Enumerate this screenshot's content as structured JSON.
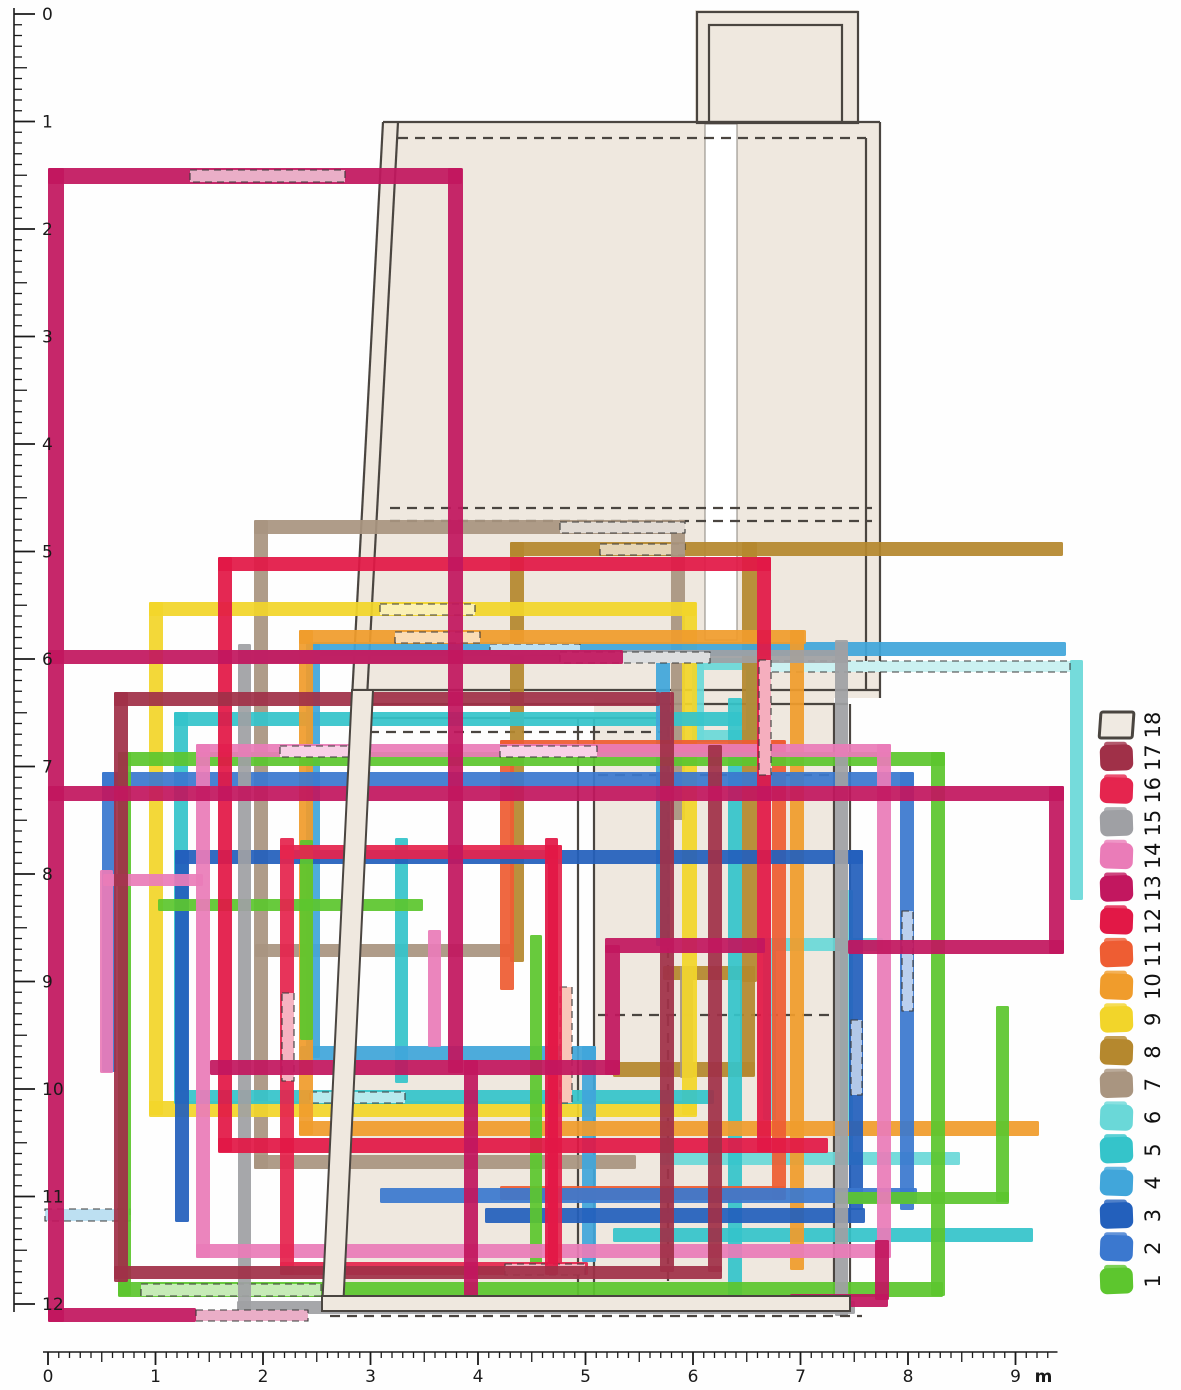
{
  "figure": {
    "kind": "archaeological-phase-plan",
    "width": 1181,
    "height": 1390,
    "paper_color": "#fefefe",
    "plan_fill": "#efe8df",
    "plan_stroke": "#4a4540"
  },
  "legend": {
    "swatch_x": 1100,
    "swatch_w": 33,
    "swatch_h": 26,
    "center_y_top": 725,
    "pitch": 32.7,
    "number_x": 1152,
    "number_font": 21,
    "items": [
      {
        "n": "18",
        "color": "#f0eae2",
        "outlined": true
      },
      {
        "n": "17",
        "color": "#a03048"
      },
      {
        "n": "16",
        "color": "#e5254e"
      },
      {
        "n": "15",
        "color": "#9fa0a4"
      },
      {
        "n": "14",
        "color": "#ea7cb8"
      },
      {
        "n": "13",
        "color": "#c2175f"
      },
      {
        "n": "12",
        "color": "#e21846"
      },
      {
        "n": "11",
        "color": "#ee5d33"
      },
      {
        "n": "10",
        "color": "#f09c2c"
      },
      {
        "n": "9",
        "color": "#f2d52a"
      },
      {
        "n": "8",
        "color": "#b5882e"
      },
      {
        "n": "7",
        "color": "#a99580"
      },
      {
        "n": "6",
        "color": "#6ad8d8"
      },
      {
        "n": "5",
        "color": "#35c4ca"
      },
      {
        "n": "4",
        "color": "#41a6da"
      },
      {
        "n": "3",
        "color": "#2360bc"
      },
      {
        "n": "2",
        "color": "#3b78cf"
      },
      {
        "n": "1",
        "color": "#5dc62e"
      }
    ]
  },
  "rulers": {
    "left": {
      "line_x": 14,
      "y0": 14,
      "unit": 107.5,
      "n_units": 12,
      "minor_per_unit": 10,
      "tick_major": 21,
      "tick_half": 13,
      "tick_minor": 8,
      "label_x": 30,
      "font": 17,
      "labels": [
        "0",
        "1",
        "2",
        "3",
        "4",
        "5",
        "6",
        "7",
        "8",
        "9",
        "10",
        "11",
        "12"
      ]
    },
    "bottom": {
      "line_y": 1352,
      "x0": 48,
      "unit": 107.5,
      "n_units": 9,
      "minor_per_unit": 10,
      "tick_major": 13,
      "tick_half": 10,
      "tick_minor": 6,
      "label_dy": 30,
      "font": 17,
      "labels": [
        "0",
        "1",
        "2",
        "3",
        "4",
        "5",
        "6",
        "7",
        "8",
        "9"
      ],
      "unit_label": "m"
    }
  },
  "plan": {
    "fills": [
      {
        "type": "rect",
        "x": 695,
        "y": 10,
        "w": 163,
        "h": 115
      },
      {
        "type": "poly",
        "points": "383,122 880,122 880,698 352,698"
      },
      {
        "type": "rect",
        "x": 705,
        "y": 124,
        "w": 32,
        "h": 516,
        "white": true
      },
      {
        "type": "rect",
        "x": 594,
        "y": 698,
        "w": 240,
        "h": 612
      },
      {
        "type": "rect",
        "x": 335,
        "y": 1050,
        "w": 259,
        "h": 258
      }
    ],
    "outline_rects": [
      {
        "x": 697,
        "y": 12,
        "w": 161,
        "h": 111
      },
      {
        "x": 709,
        "y": 25,
        "w": 133,
        "h": 97
      }
    ],
    "lines": [
      {
        "x1": 383,
        "y1": 122,
        "x2": 352,
        "y2": 698
      },
      {
        "x1": 398,
        "y1": 122,
        "x2": 367,
        "y2": 698
      },
      {
        "x1": 383,
        "y1": 122,
        "x2": 880,
        "y2": 122
      },
      {
        "x1": 398,
        "y1": 138,
        "x2": 866,
        "y2": 138,
        "dash": true
      },
      {
        "x1": 880,
        "y1": 122,
        "x2": 880,
        "y2": 698
      },
      {
        "x1": 866,
        "y1": 138,
        "x2": 866,
        "y2": 690
      },
      {
        "x1": 390,
        "y1": 508,
        "x2": 872,
        "y2": 508,
        "dash": true
      },
      {
        "x1": 390,
        "y1": 521,
        "x2": 872,
        "y2": 521,
        "dash": true
      },
      {
        "x1": 352,
        "y1": 690,
        "x2": 880,
        "y2": 690
      },
      {
        "x1": 352,
        "y1": 704,
        "x2": 848,
        "y2": 704
      },
      {
        "x1": 352,
        "y1": 718,
        "x2": 662,
        "y2": 718
      },
      {
        "x1": 352,
        "y1": 732,
        "x2": 662,
        "y2": 732,
        "dash": true
      },
      {
        "x1": 578,
        "y1": 718,
        "x2": 578,
        "y2": 1296
      },
      {
        "x1": 594,
        "y1": 718,
        "x2": 594,
        "y2": 1296
      },
      {
        "x1": 834,
        "y1": 704,
        "x2": 834,
        "y2": 1296
      },
      {
        "x1": 850,
        "y1": 704,
        "x2": 850,
        "y2": 1296
      },
      {
        "x1": 598,
        "y1": 775,
        "x2": 832,
        "y2": 775,
        "dash": true
      },
      {
        "x1": 598,
        "y1": 1015,
        "x2": 832,
        "y2": 1015,
        "dash": true
      },
      {
        "x1": 668,
        "y1": 710,
        "x2": 668,
        "y2": 1285,
        "dash": true
      }
    ],
    "bands_over": [
      {
        "type": "poly",
        "points": "352,690 373,690 343,1310 322,1310"
      },
      {
        "type": "rect",
        "x": 322,
        "y": 1296,
        "w": 528,
        "h": 15
      }
    ],
    "bands_over_dash": [
      {
        "x1": 330,
        "y1": 1316,
        "x2": 862,
        "y2": 1316
      }
    ]
  },
  "phases": {
    "draw_order": [
      "6",
      "8",
      "7",
      "9",
      "5",
      "4",
      "10",
      "11",
      "3",
      "2",
      "1",
      "15",
      "14",
      "16",
      "12",
      "17",
      "13"
    ],
    "byId": {
      "6": {
        "color": "#6ad8d8",
        "bars": [
          [
            692,
            658,
            66,
            12
          ],
          [
            692,
            658,
            12,
            84
          ],
          [
            746,
            658,
            12,
            84
          ],
          [
            692,
            730,
            66,
            12
          ],
          [
            1070,
            660,
            13,
            240
          ],
          [
            763,
            938,
            120,
            13
          ],
          [
            763,
            950,
            13,
            170
          ],
          [
            660,
            1152,
            300,
            13
          ],
          [
            840,
            890,
            13,
            270
          ]
        ],
        "pale": [
          [
            760,
            661,
            310,
            11
          ]
        ]
      },
      "8": {
        "color": "#b5882e",
        "bars": [
          [
            510,
            542,
            553,
            14
          ],
          [
            510,
            542,
            14,
            420
          ],
          [
            742,
            542,
            15,
            440
          ],
          [
            663,
            966,
            92,
            14
          ],
          [
            740,
            966,
            15,
            110
          ],
          [
            613,
            1062,
            142,
            15
          ]
        ],
        "pale": [
          [
            600,
            544,
            85,
            11
          ]
        ]
      },
      "7": {
        "color": "#a99580",
        "bars": [
          [
            254,
            520,
            14,
            649
          ],
          [
            254,
            520,
            431,
            14
          ],
          [
            671,
            520,
            14,
            300
          ],
          [
            680,
            966,
            13,
            112
          ],
          [
            255,
            944,
            258,
            13
          ],
          [
            254,
            1155,
            382,
            14
          ]
        ],
        "pale": [
          [
            560,
            522,
            125,
            11
          ]
        ]
      },
      "9": {
        "color": "#f2d52a",
        "bars": [
          [
            149,
            602,
            14,
            513
          ],
          [
            149,
            602,
            547,
            14
          ],
          [
            682,
            602,
            15,
            513
          ],
          [
            149,
            1101,
            548,
            16
          ]
        ],
        "pale": [
          [
            380,
            604,
            95,
            11
          ]
        ]
      },
      "5": {
        "color": "#35c4ca",
        "bars": [
          [
            174,
            712,
            568,
            14
          ],
          [
            174,
            712,
            14,
            380
          ],
          [
            728,
            698,
            14,
            614
          ],
          [
            395,
            838,
            13,
            245
          ],
          [
            174,
            1090,
            540,
            14
          ],
          [
            613,
            1228,
            420,
            14
          ]
        ],
        "pale": [
          [
            310,
            1092,
            95,
            11
          ]
        ]
      },
      "4": {
        "color": "#41a6da",
        "bars": [
          [
            306,
            642,
            760,
            14
          ],
          [
            306,
            642,
            14,
            416
          ],
          [
            656,
            656,
            14,
            290
          ],
          [
            300,
            1046,
            296,
            14
          ],
          [
            582,
            1046,
            14,
            216
          ]
        ],
        "pale": [
          [
            490,
            644,
            90,
            11
          ],
          [
            45,
            1209,
            85,
            12
          ]
        ]
      },
      "10": {
        "color": "#f09c2c",
        "bars": [
          [
            299,
            630,
            507,
            14
          ],
          [
            299,
            630,
            14,
            505
          ],
          [
            790,
            630,
            14,
            640
          ],
          [
            299,
            1121,
            740,
            15
          ]
        ],
        "pale": [
          [
            395,
            632,
            85,
            11
          ]
        ]
      },
      "11": {
        "color": "#ee5d33",
        "bars": [
          [
            500,
            740,
            285,
            14
          ],
          [
            500,
            740,
            14,
            250
          ],
          [
            772,
            740,
            14,
            460
          ],
          [
            500,
            1186,
            285,
            14
          ]
        ],
        "pale": [
          [
            560,
            987,
            12,
            116
          ]
        ]
      },
      "3": {
        "color": "#2360bc",
        "bars": [
          [
            175,
            850,
            14,
            372
          ],
          [
            175,
            850,
            688,
            14
          ],
          [
            849,
            850,
            14,
            360
          ],
          [
            485,
            1208,
            380,
            15
          ]
        ],
        "pale": [
          [
            851,
            1020,
            11,
            75
          ]
        ]
      },
      "2": {
        "color": "#3b78cf",
        "bars": [
          [
            102,
            772,
            14,
            300
          ],
          [
            102,
            772,
            812,
            14
          ],
          [
            900,
            772,
            14,
            438
          ],
          [
            380,
            1188,
            537,
            15
          ]
        ],
        "pale": [
          [
            902,
            911,
            11,
            100
          ]
        ]
      },
      "1": {
        "color": "#5dc62e",
        "bars": [
          [
            118,
            752,
            13,
            544
          ],
          [
            118,
            752,
            827,
            14
          ],
          [
            931,
            752,
            14,
            544
          ],
          [
            118,
            1282,
            825,
            15
          ],
          [
            300,
            840,
            13,
            200
          ],
          [
            158,
            899,
            265,
            12
          ],
          [
            996,
            1006,
            13,
            196
          ],
          [
            836,
            1192,
            173,
            12
          ],
          [
            530,
            935,
            12,
            330
          ]
        ],
        "pale": [
          [
            141,
            1284,
            180,
            12
          ]
        ]
      },
      "15": {
        "color": "#9fa0a4",
        "bars": [
          [
            238,
            644,
            13,
            672
          ],
          [
            238,
            650,
            610,
            13
          ],
          [
            835,
            640,
            13,
            676
          ],
          [
            237,
            1301,
            618,
            13
          ]
        ],
        "pale": [
          [
            560,
            652,
            150,
            11
          ]
        ]
      },
      "14": {
        "color": "#ea7cb8",
        "bars": [
          [
            196,
            744,
            14,
            514
          ],
          [
            196,
            744,
            695,
            13
          ],
          [
            877,
            744,
            14,
            514
          ],
          [
            196,
            1244,
            695,
            14
          ],
          [
            100,
            870,
            13,
            203
          ],
          [
            103,
            874,
            100,
            12
          ],
          [
            428,
            930,
            13,
            117
          ]
        ],
        "pale": [
          [
            280,
            746,
            77,
            11
          ],
          [
            500,
            746,
            97,
            11
          ]
        ]
      },
      "16": {
        "color": "#e5254e",
        "bars": [
          [
            280,
            838,
            14,
            437
          ],
          [
            280,
            845,
            282,
            14
          ],
          [
            548,
            845,
            14,
            430
          ],
          [
            280,
            1262,
            308,
            13
          ]
        ],
        "pale": [
          [
            282,
            993,
            12,
            88
          ],
          [
            505,
            1264,
            80,
            11
          ]
        ]
      },
      "12": {
        "color": "#e21846",
        "bars": [
          [
            218,
            557,
            14,
            595
          ],
          [
            218,
            557,
            553,
            14
          ],
          [
            757,
            557,
            14,
            595
          ],
          [
            218,
            1138,
            610,
            15
          ],
          [
            545,
            838,
            13,
            437
          ]
        ],
        "pale": [
          [
            759,
            660,
            12,
            115
          ]
        ]
      },
      "17": {
        "color": "#a03048",
        "bars": [
          [
            114,
            692,
            14,
            590
          ],
          [
            114,
            692,
            546,
            14
          ],
          [
            660,
            692,
            14,
            580
          ],
          [
            708,
            745,
            14,
            527
          ],
          [
            114,
            1266,
            608,
            13
          ]
        ],
        "pale": []
      },
      "13": {
        "color": "#c2175f",
        "bars": [
          [
            48,
            168,
            16,
            1154
          ],
          [
            48,
            168,
            414,
            16
          ],
          [
            448,
            168,
            15,
            905
          ],
          [
            48,
            650,
            575,
            14
          ],
          [
            48,
            786,
            1016,
            15
          ],
          [
            1049,
            786,
            15,
            168
          ],
          [
            848,
            940,
            216,
            14
          ],
          [
            605,
            938,
            160,
            15
          ],
          [
            605,
            945,
            15,
            130
          ],
          [
            210,
            1060,
            410,
            15
          ],
          [
            464,
            1060,
            14,
            252
          ],
          [
            875,
            1240,
            14,
            60
          ],
          [
            790,
            1294,
            98,
            13
          ],
          [
            48,
            1308,
            148,
            14
          ]
        ],
        "pale": [
          [
            190,
            170,
            155,
            12
          ],
          [
            196,
            1310,
            112,
            11
          ]
        ]
      }
    }
  }
}
